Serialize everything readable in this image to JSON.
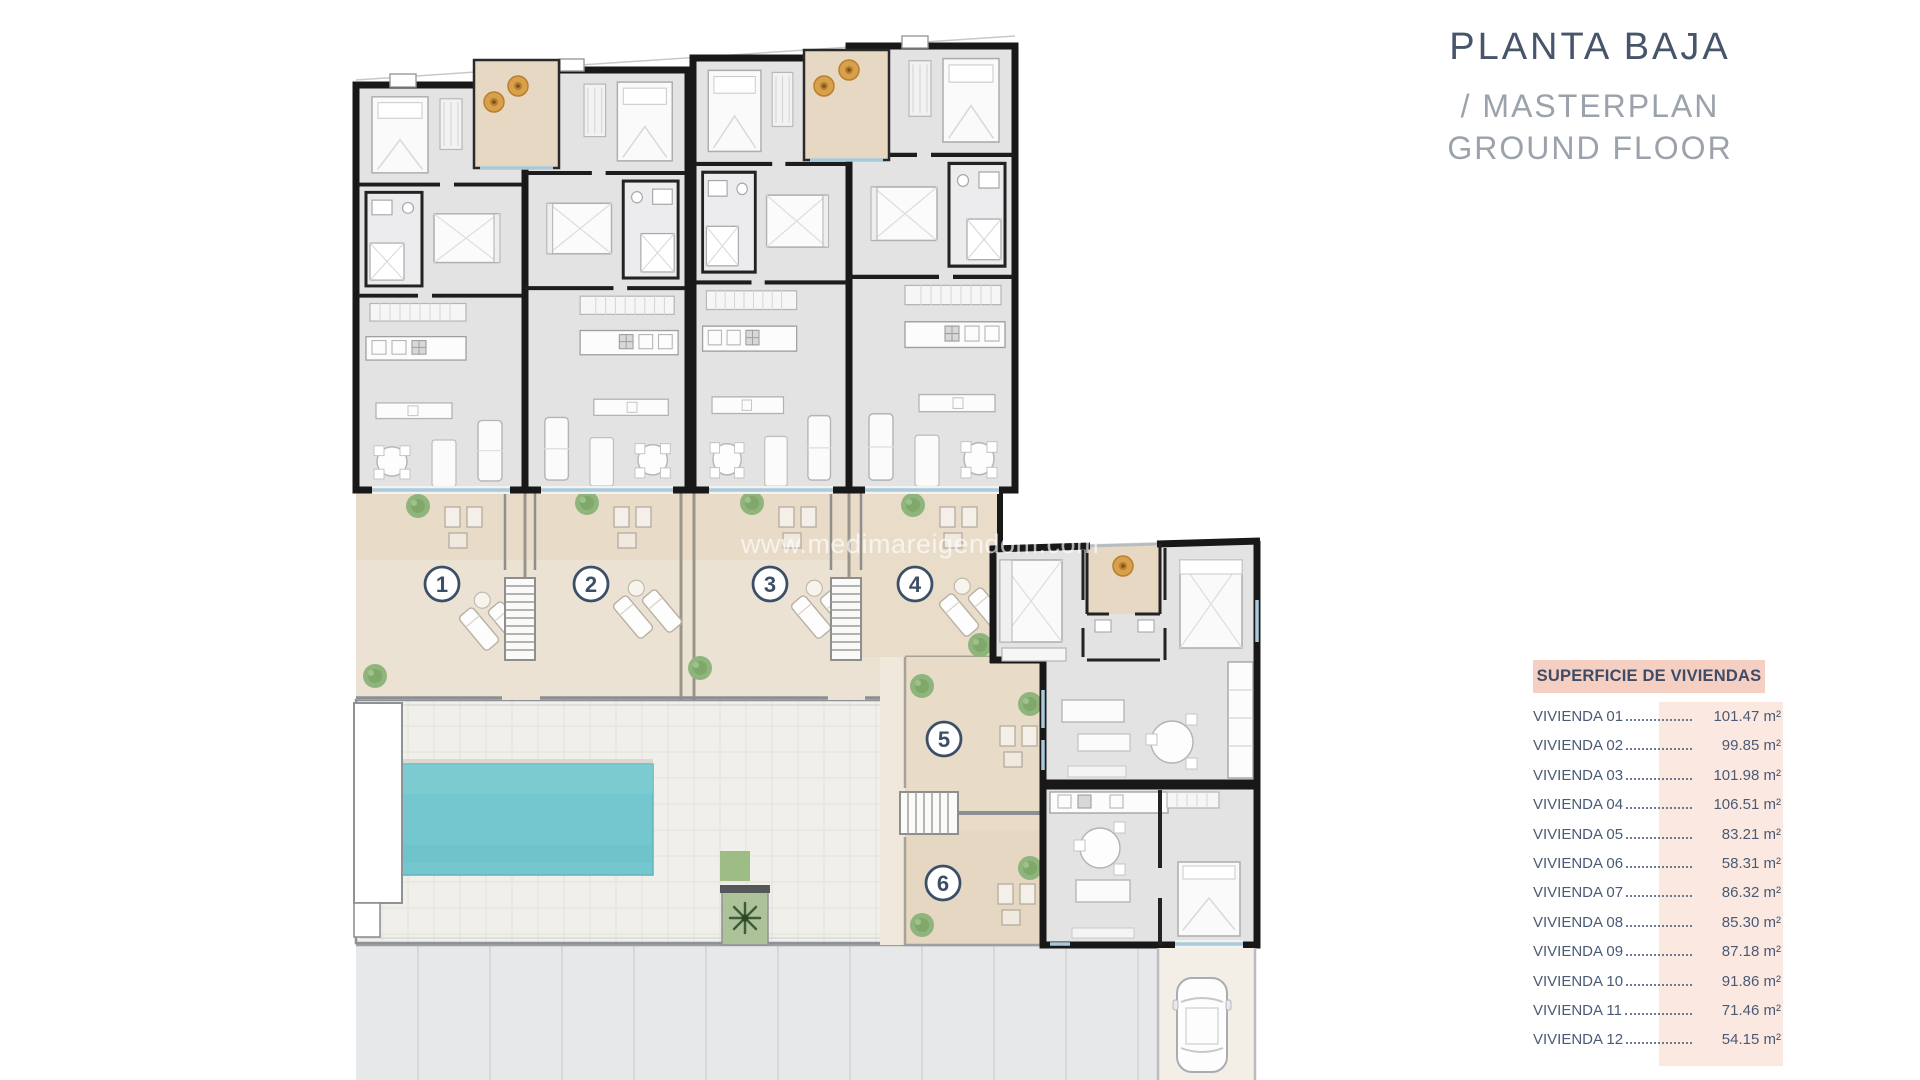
{
  "title": {
    "line1": "PLANTA BAJA",
    "line2": "/ MASTERPLAN",
    "line3": "GROUND FLOOR"
  },
  "watermark": "www.medimareigendom.com",
  "surface_table": {
    "header": "SUPERFICIE DE VIVIENDAS",
    "rows": [
      {
        "label": "VIVIENDA 01",
        "value": "101.47 m²"
      },
      {
        "label": "VIVIENDA 02",
        "value": "99.85 m²"
      },
      {
        "label": "VIVIENDA 03",
        "value": "101.98 m²"
      },
      {
        "label": "VIVIENDA 04",
        "value": "106.51 m²"
      },
      {
        "label": "VIVIENDA 05",
        "value": "83.21 m²"
      },
      {
        "label": "VIVIENDA 06",
        "value": "58.31 m²"
      },
      {
        "label": "VIVIENDA 07",
        "value": "86.32 m²"
      },
      {
        "label": "VIVIENDA 08",
        "value": "85.30 m²"
      },
      {
        "label": "VIVIENDA 09",
        "value": "87.18 m²"
      },
      {
        "label": "VIVIENDA 10",
        "value": "91.86 m²"
      },
      {
        "label": "VIVIENDA 11",
        "value": "71.46 m²"
      },
      {
        "label": "VIVIENDA 12",
        "value": "54.15 m²"
      }
    ]
  },
  "plan": {
    "markers": [
      "1",
      "2",
      "3",
      "4",
      "5",
      "6"
    ],
    "colors": {
      "wall": "#181818",
      "floor": "#e3e3e4",
      "terrace": "#e8dbc7",
      "terrace_light": "#ece2d3",
      "pool": "#75c7cf",
      "deck": "#f1efe9",
      "road": "#e7e8ea",
      "marker": "#3c4f68",
      "tree_orange": "#d9a04b",
      "bush_green": "#8fb57c",
      "accent_pink": "#f4cfc2"
    }
  }
}
